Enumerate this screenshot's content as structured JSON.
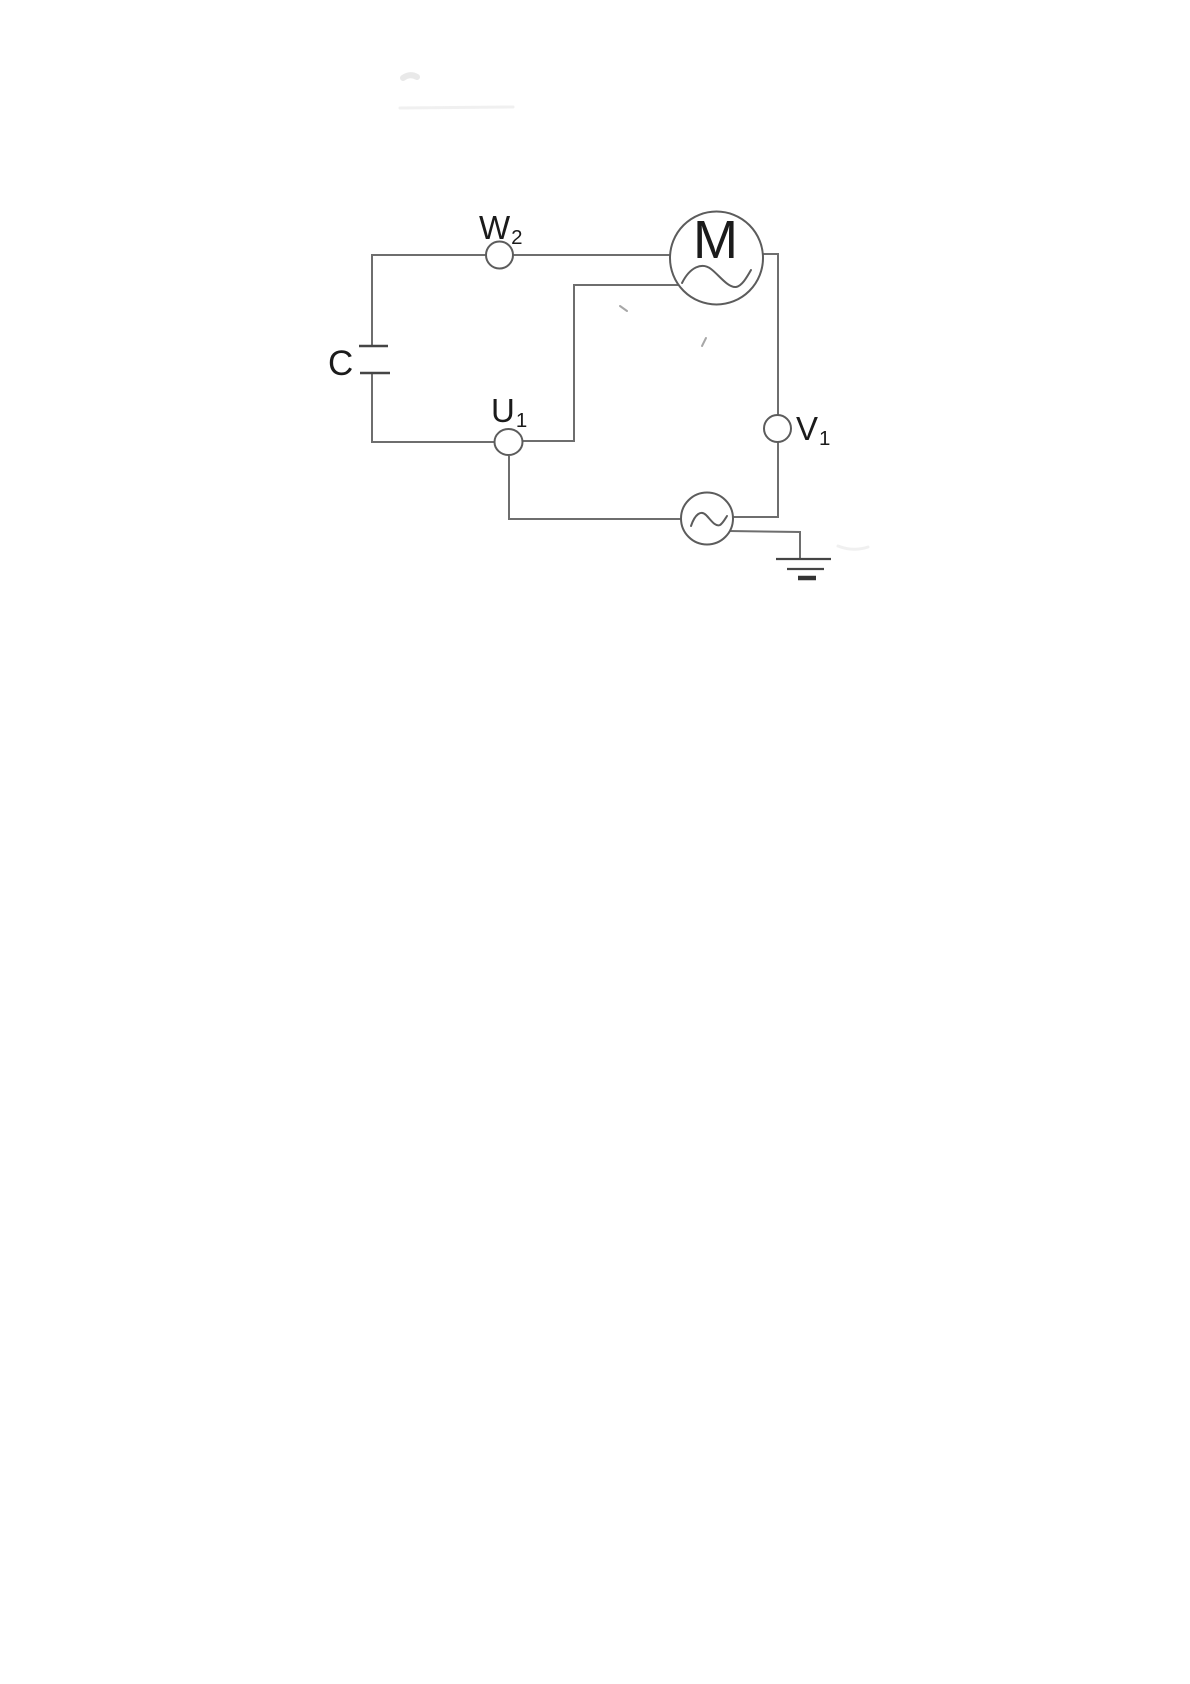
{
  "page": {
    "kind": "scanned circuit diagram on white paper",
    "background": "#ffffff"
  },
  "diagram": {
    "type": "single-phase AC motor circuit",
    "labels": {
      "c": {
        "base": "C"
      },
      "w2": {
        "base": "W",
        "sub": "2"
      },
      "u1": {
        "base": "U",
        "sub": "1"
      },
      "v1": {
        "base": "V",
        "sub": "1"
      },
      "m": {
        "base": "M"
      }
    },
    "components": [
      {
        "name": "capacitor",
        "label": "C"
      },
      {
        "name": "terminal-w2",
        "label": "W2"
      },
      {
        "name": "terminal-u1",
        "label": "U1"
      },
      {
        "name": "terminal-v1",
        "label": "V1"
      },
      {
        "name": "ac-motor",
        "label": "M",
        "symbol": "circle with M and sine wave"
      },
      {
        "name": "ac-source",
        "symbol": "circle with sine wave"
      },
      {
        "name": "earth-ground",
        "symbol": "three stacked bars"
      }
    ],
    "colors": {
      "wire": "#6e6e6e",
      "component": "#5c5c5c",
      "plate": "#454545",
      "ground_dark": "#333333",
      "text": "#1b1b1b"
    }
  }
}
